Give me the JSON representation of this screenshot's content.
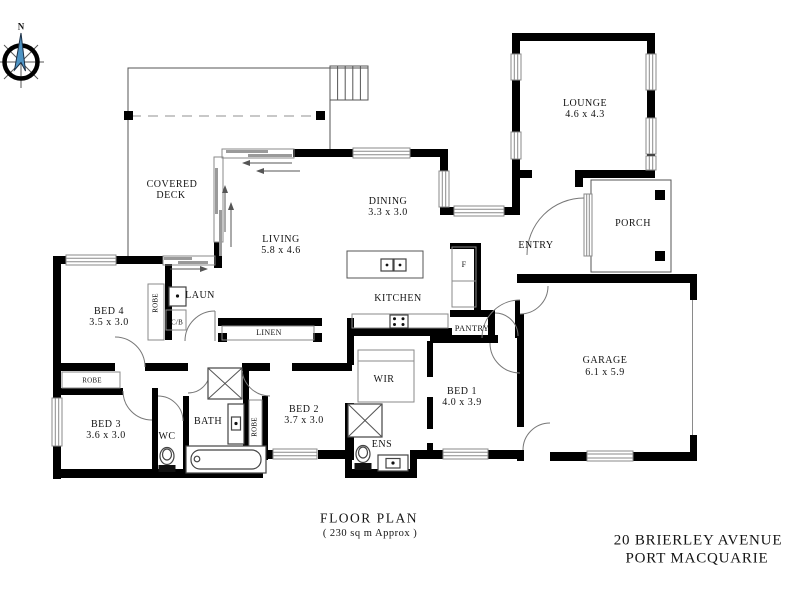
{
  "compass": {
    "label": "N"
  },
  "plan": {
    "rooms": {
      "covered_deck": {
        "line1": "COVERED",
        "line2": "DECK"
      },
      "lounge": {
        "name": "LOUNGE",
        "dims": "4.6 x 4.3"
      },
      "dining": {
        "name": "DINING",
        "dims": "3.3 x 3.0"
      },
      "living": {
        "name": "LIVING",
        "dims": "5.8 x 4.6"
      },
      "entry": {
        "name": "ENTRY"
      },
      "porch": {
        "name": "PORCH"
      },
      "kitchen": {
        "name": "KITCHEN"
      },
      "pantry": {
        "name": "PANTRY"
      },
      "fridge": {
        "name": "F"
      },
      "laundry": {
        "name": "LAUN"
      },
      "cupboard": {
        "name": "C/B"
      },
      "bed4": {
        "name": "BED 4",
        "dims": "3.5 x 3.0"
      },
      "bed3": {
        "name": "BED 3",
        "dims": "3.6 x 3.0"
      },
      "bed2": {
        "name": "BED 2",
        "dims": "3.7 x 3.0"
      },
      "bed1": {
        "name": "BED 1",
        "dims": "4.0 x 3.9"
      },
      "wc": {
        "name": "WC"
      },
      "bath": {
        "name": "BATH"
      },
      "ens": {
        "name": "ENS"
      },
      "wir": {
        "name": "WIR"
      },
      "linen": {
        "name": "LINEN"
      },
      "garage": {
        "name": "GARAGE",
        "dims": "6.1 x 5.9"
      },
      "robe_bed4": {
        "name": "ROBE"
      },
      "robe_hall": {
        "name": "ROBE"
      },
      "robe_bed2": {
        "name": "ROBE"
      }
    }
  },
  "footer": {
    "title": "FLOOR PLAN",
    "subtitle": "( 230 sq m Approx )"
  },
  "address": {
    "line1": "20 BRIERLEY AVENUE",
    "line2": "PORT MACQUARIE"
  },
  "colors": {
    "wall": "#000000",
    "line": "#8a8a8a",
    "compass_needle": "#4e94c4",
    "text": "#141414"
  }
}
